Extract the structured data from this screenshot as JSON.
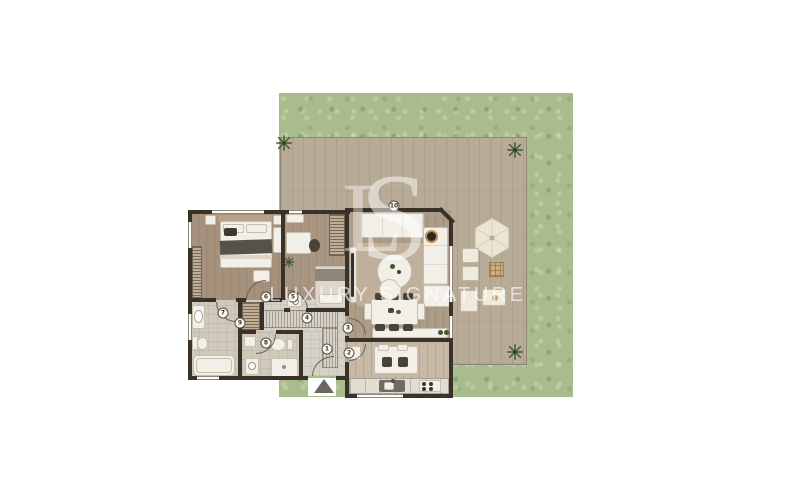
{
  "brand": {
    "monogram_l": "L",
    "monogram_s": "S",
    "name": "LUXURY SIGNATURE"
  },
  "unit_labels": [
    "1",
    "2",
    "3",
    "4",
    "5",
    "6",
    "7",
    "8",
    "9",
    "10"
  ],
  "icons": {
    "entrance_arrow": "triangle-up",
    "plant": "plant-top-view",
    "umbrella": "patio-umbrella-hexagon"
  },
  "colors": {
    "garden_green": "#a9bd8c",
    "deck_wood": "#b8ab97",
    "interior_wood": "#ab9a85",
    "wet_floor": "#cfc9bc",
    "wall": "#3a3129",
    "furniture": "#f2efe8",
    "accent_dark": "#4a4139",
    "plant_green": "#3f5a2e",
    "wicker_tan": "#c9ad7b",
    "watermark": "#ffffff"
  }
}
